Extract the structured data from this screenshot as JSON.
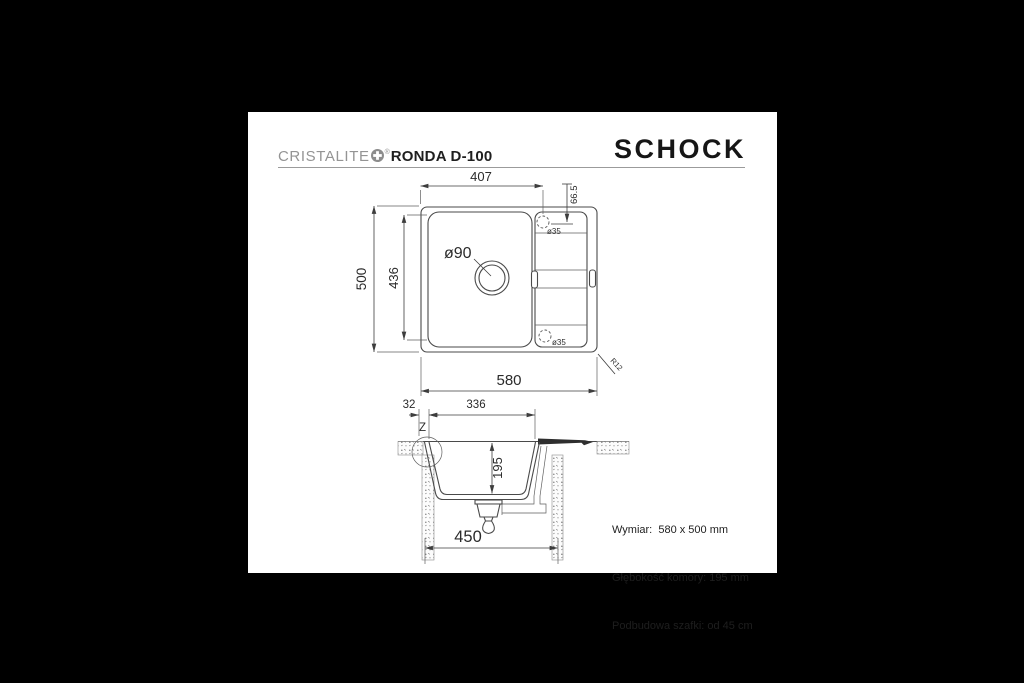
{
  "header": {
    "series": "CRISTALITE",
    "registered_mark": "®",
    "model": "RONDA D-100",
    "logo": "SCHOCK"
  },
  "top_view": {
    "dim_width_to_hole": "407",
    "dim_hole_offset": "66.5",
    "dim_overall_height": "500",
    "dim_bowl_height": "436",
    "dim_overall_width": "580",
    "dim_corner_radius": "R12",
    "label_drain": "ø90",
    "label_hole_top": "ø35",
    "label_hole_bottom": "ø35"
  },
  "section_view": {
    "dim_edge": "32",
    "dim_bowl_width": "336",
    "dim_bowl_depth": "195",
    "dim_cabinet_width": "450",
    "detail_marker": "Z"
  },
  "specs": {
    "line1": "Wymiar:  580 x 500 mm",
    "line2": "Głębokość komory: 195 mm",
    "line3": "Podbudowa szafki: od 45 cm"
  },
  "colors": {
    "background": "#000000",
    "sheet": "#ffffff",
    "drawing_line": "#4a4a4a",
    "brand_gray": "#949494",
    "logo_black": "#161616"
  }
}
